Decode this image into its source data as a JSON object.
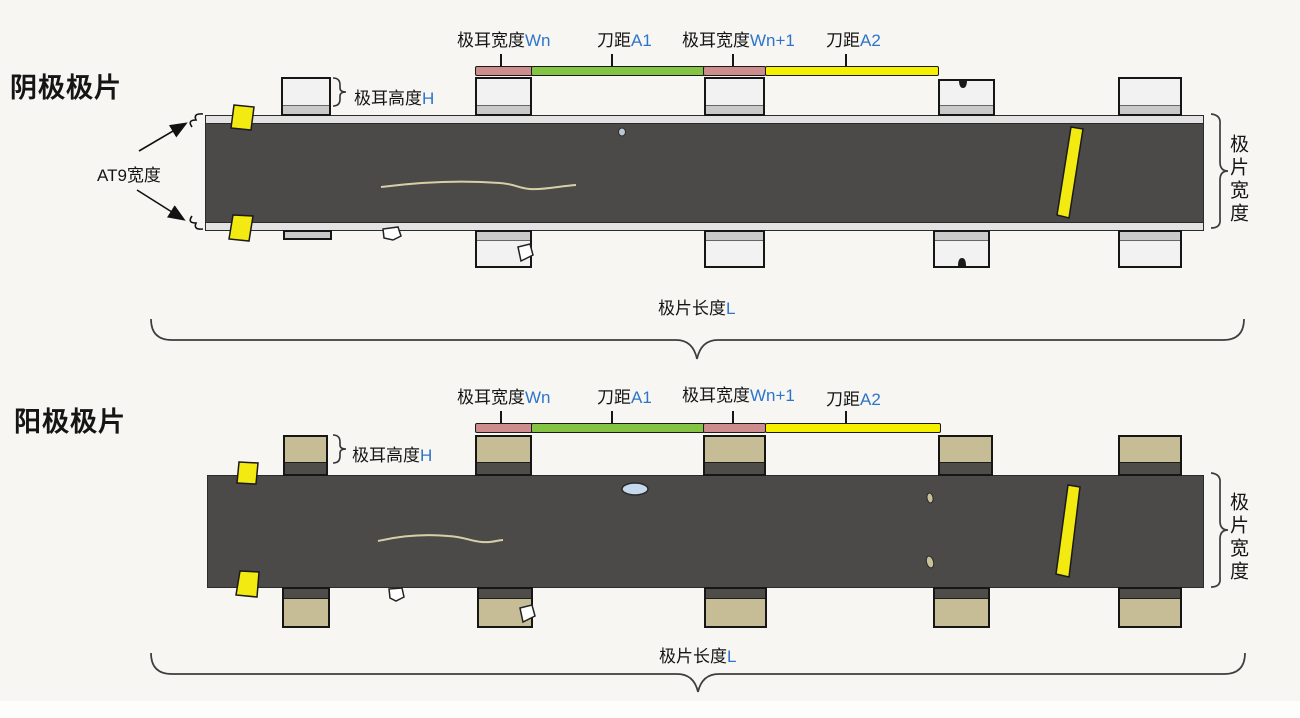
{
  "diagram": {
    "sections": [
      {
        "title": "阴极极片"
      },
      {
        "title": "阳极极片"
      }
    ],
    "labels": {
      "tab_width": "极耳宽度",
      "wn": "Wn",
      "knife": "刀距",
      "a1": "A1",
      "wn1": "Wn+1",
      "a2": "A2",
      "tab_height": "极耳高度",
      "h": "H",
      "at9": "AT9宽度",
      "sheet_width": "极片宽度",
      "sheet_length": "极片长度",
      "l": "L"
    },
    "colors": {
      "tab_width_bar": "#cd8d8d",
      "knife_a1_bar": "#85c342",
      "knife_a2_bar": "#f5ef00",
      "cathode_tab": "#f2f2f2",
      "cathode_tab_band": "#c9c9c9",
      "anode_tab": "#c6bc96",
      "anode_tab_band": "#4e4d4a",
      "strip": "#4b4a48",
      "strip_edge": "#e3e3e3",
      "accent_blue": "#2d74cb",
      "edge_mark_yellow": "#f2ea10",
      "defect_blue": "#c6d9ec",
      "defect_tan": "#c9c09a",
      "scratch": "#d8cfa8"
    }
  }
}
